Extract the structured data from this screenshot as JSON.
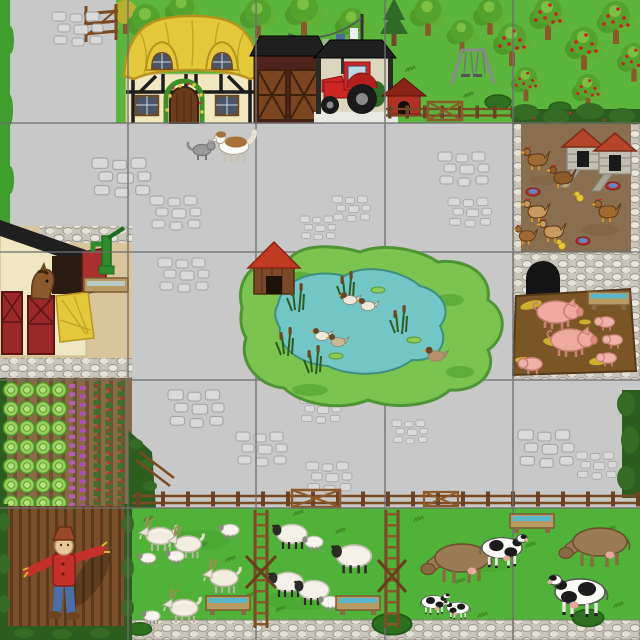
{
  "scene": {
    "description": "Bird's-eye illustrated farm play mat divided into a 5x5 grid of tiles",
    "grid": {
      "rows": 5,
      "cols": 5,
      "cell_px": 128
    },
    "colors": {
      "yard": "#c8c8c8",
      "grass_top": "#5cb53c",
      "grass_field": "#50b238",
      "hedge": "#2d5c1f",
      "island": "#7cc450",
      "pond": "#72c6c6",
      "dirt": "#8a6e50",
      "mud": "#7a5526",
      "sand": "#d9c49c",
      "thatch": "#e3c83b",
      "cream_wall": "#f2e8c0",
      "roof_black": "#1f1f1f",
      "barn_red": "#4e241c",
      "door_brown": "#7a4520",
      "tractor_red": "#cc2626",
      "kennel_red": "#b03226",
      "coop_roof": "#b5452a",
      "pig_pink": "#efaaa0",
      "sheep_wool": "#f3f1e8",
      "cow_brown": "#9a7a52",
      "fence_brown": "#7a4a22",
      "trough_water": "#5ab8cc",
      "stone": "#e6e3da",
      "grid_line": "#6f6f6f"
    },
    "regions": [
      {
        "name": "farmyard",
        "label": "Grey cobbled farmyard",
        "rows": "1-4",
        "cols": "1-4"
      },
      {
        "name": "farmyard-gate",
        "label": "Wooden gate",
        "row": 1,
        "col": 1
      },
      {
        "name": "farmhouse",
        "label": "Thatched farmhouse with flower-arched door",
        "row": 1,
        "col": 2
      },
      {
        "name": "barn",
        "label": "Barn with wooden doors",
        "row": 1,
        "col": 3
      },
      {
        "name": "tractor-shelter",
        "label": "Open shelter with red tractor",
        "row": 1,
        "col": 3
      },
      {
        "name": "washing-line",
        "label": "Washing line with clothes",
        "row": 1,
        "col": 3
      },
      {
        "name": "dog-kennel",
        "label": "Red dog kennel",
        "row": 1,
        "col": 4
      },
      {
        "name": "swing",
        "label": "Swing set",
        "row": 1,
        "col": 4
      },
      {
        "name": "orchard",
        "label": "Apple orchard",
        "row": 1,
        "cols": "4-5"
      },
      {
        "name": "dog-and-cat",
        "label": "Sheepdog meeting a grey cat",
        "row": 2,
        "col": 2
      },
      {
        "name": "chicken-run",
        "label": "Chicken run with two hen houses and feed bowls",
        "row": 2,
        "col": 5,
        "animals": {
          "hens": 6,
          "chicks": 2
        }
      },
      {
        "name": "stable",
        "label": "Stable with horse, hay and water pump",
        "row": 3,
        "col": 1,
        "animals": {
          "horses": 1
        }
      },
      {
        "name": "duck-pond",
        "label": "Duck pond on grassy island with duck house and reeds",
        "row": 3,
        "cols": "2-4",
        "animals": {
          "ducks": 5
        }
      },
      {
        "name": "pig-sty",
        "label": "Stone pig sty with straw pen",
        "row": 3,
        "col": 5,
        "animals": {
          "pigs": 2,
          "piglets": 4
        }
      },
      {
        "name": "vegetable-garden",
        "label": "Vegetable garden with cabbage, purple and red crop rows",
        "row": 4,
        "col": 1
      },
      {
        "name": "ploughed-field",
        "label": "Ploughed field with scarecrow",
        "row": 5,
        "col": 1
      },
      {
        "name": "goat-paddock",
        "label": "Goat paddock with water trough and ladder stile",
        "row": 5,
        "col": 2,
        "animals": {
          "goats": 3,
          "kids": 3,
          "lambs": 1
        }
      },
      {
        "name": "sheep-field",
        "label": "Sheep field with water trough",
        "row": 5,
        "col": 3,
        "animals": {
          "sheep": 4,
          "lambs": 2
        }
      },
      {
        "name": "cow-field",
        "label": "Cow pasture with water trough",
        "row": 5,
        "cols": "4-5",
        "animals": {
          "cows": 4,
          "calves": 2
        }
      }
    ]
  }
}
